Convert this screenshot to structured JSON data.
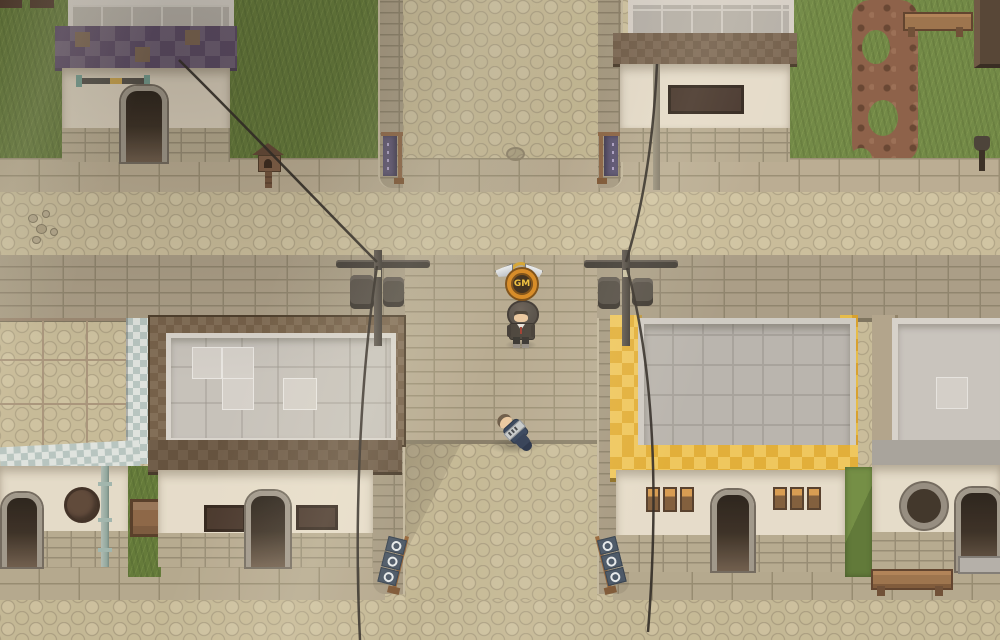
{
  "meta": {
    "scene_type": "top-down pixel RPG village crossing",
    "perspective": "top-down"
  },
  "hud": {
    "gm_badge_label": "GM"
  },
  "characters": [
    {
      "id": "game-master",
      "name": "GM character",
      "state": "standing",
      "outfit": "dark hooded jacket",
      "badge": "GM"
    },
    {
      "id": "player-down",
      "name": "fallen player",
      "state": "lying on ground",
      "outfit": "navy uniform"
    }
  ],
  "buildings": [
    {
      "id": "top-left-house",
      "roof": "purple checker trim"
    },
    {
      "id": "top-center-house",
      "roof": "brown checker trim"
    },
    {
      "id": "mid-left-house",
      "roof": "tan tile with white-blue checker trim"
    },
    {
      "id": "mid-center-house",
      "roof": "brown checker border, gray top"
    },
    {
      "id": "shop-yellow",
      "roof": "gold checker awning"
    },
    {
      "id": "mid-right-house",
      "roof": "tan trim, gray top"
    }
  ],
  "props": [
    "utility-pole-left",
    "utility-pole-right",
    "power-cables",
    "purple-banner-left",
    "purple-banner-right",
    "shop-flags-left",
    "shop-flags-right",
    "bench-top-right",
    "bench-bottom-right",
    "wooden-crate",
    "birdhouse-post",
    "shovel",
    "wall-staff",
    "round-sign",
    "hanging-sign-board",
    "drainpipes",
    "dirt-path"
  ],
  "palette": {
    "gold1": "#e3ae33",
    "gold2": "#f1c75a",
    "purple1": "#695a72",
    "purple2": "#554462",
    "navy": "#2e3e58",
    "grass1": "#5f7636",
    "grass2": "#6d8641",
    "cobble": "#c6ba97",
    "cream": "#e3dac8",
    "brick": "#a99d85",
    "wood": "#8a6242",
    "cable": "#2b2622",
    "skin": "#ecc9a0",
    "badge_ring": "#d8891f",
    "badge_text": "#f2c23c"
  }
}
